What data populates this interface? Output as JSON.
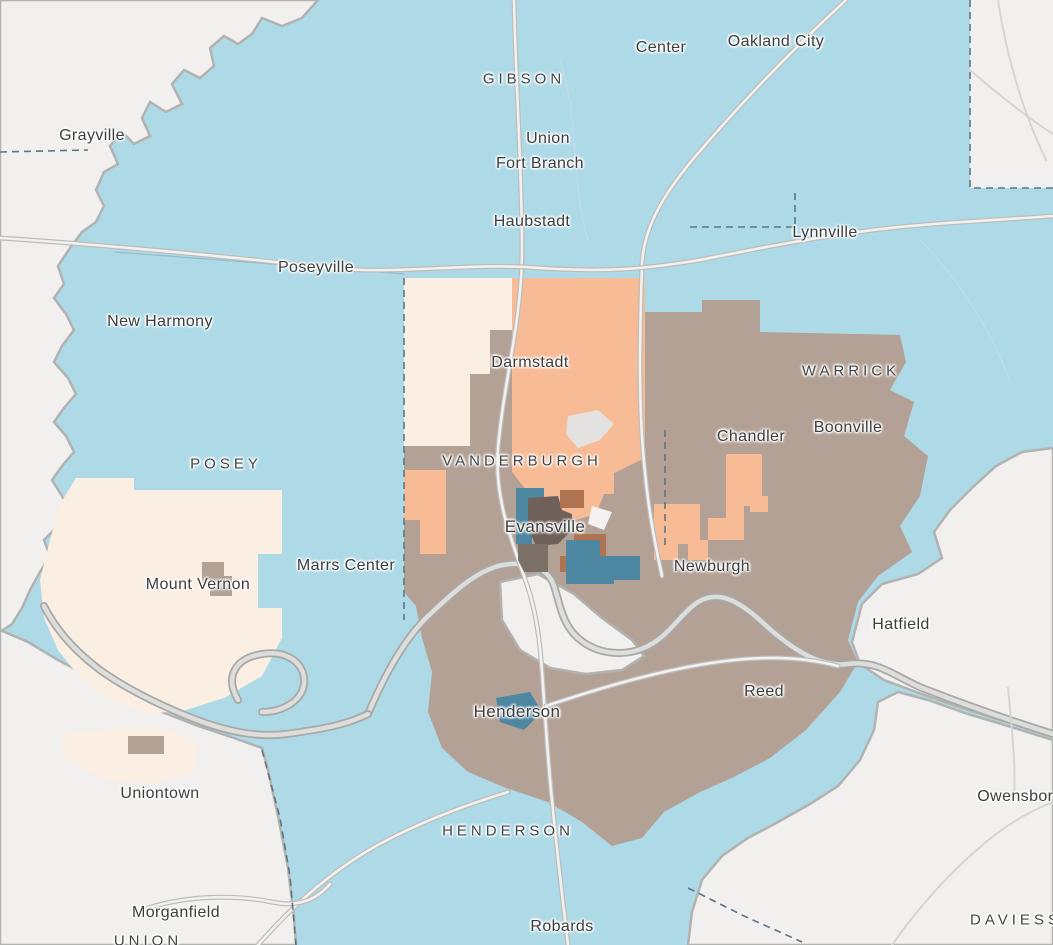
{
  "map": {
    "description": "Choropleth map of the Evansville Indiana-Kentucky tri-state region with census areas shaded by class",
    "palette": {
      "region_blue": "#aedae8",
      "region_tan": "#b3a195",
      "region_orange": "#f7bb96",
      "region_cream": "#fbeee3",
      "tract_teal": "#4e87a2",
      "tract_rust": "#b07352",
      "tract_dark_brown": "#6f6159",
      "tract_gray_brown": "#7d7066",
      "tract_white": "#f4f2f0",
      "airport_gray": "#e4e2e0",
      "out_of_area": "#f1f0ee",
      "river_casing": "#a8a8a6",
      "river_fill": "#dddddc",
      "road_casing": "#bcbcba",
      "road_fill": "#f2f1ef",
      "boundary_dashed": "#5f7682",
      "label_text": "#3e3e3e",
      "label_halo": "#ffffff"
    },
    "labels": [
      {
        "id": "center",
        "text": "Center",
        "kind": "town",
        "x": 661,
        "y": 48
      },
      {
        "id": "oakland-city",
        "text": "Oakland City",
        "kind": "town",
        "x": 776,
        "y": 42
      },
      {
        "id": "gibson",
        "text": "GIBSON",
        "kind": "county",
        "x": 524,
        "y": 79
      },
      {
        "id": "grayville",
        "text": "Grayville",
        "kind": "town",
        "x": 92,
        "y": 136
      },
      {
        "id": "union-gibson",
        "text": "Union",
        "kind": "town",
        "x": 548,
        "y": 139
      },
      {
        "id": "fort-branch",
        "text": "Fort Branch",
        "kind": "town",
        "x": 540,
        "y": 164
      },
      {
        "id": "haubstadt",
        "text": "Haubstadt",
        "kind": "town",
        "x": 532,
        "y": 222
      },
      {
        "id": "lynnville",
        "text": "Lynnville",
        "kind": "town",
        "x": 825,
        "y": 233
      },
      {
        "id": "poseyville",
        "text": "Poseyville",
        "kind": "town",
        "x": 316,
        "y": 268
      },
      {
        "id": "new-harmony",
        "text": "New Harmony",
        "kind": "town",
        "x": 160,
        "y": 322
      },
      {
        "id": "darmstadt",
        "text": "Darmstadt",
        "kind": "town",
        "x": 530,
        "y": 363
      },
      {
        "id": "warrick",
        "text": "WARRICK",
        "kind": "county",
        "x": 851,
        "y": 371
      },
      {
        "id": "boonville",
        "text": "Boonville",
        "kind": "town",
        "x": 848,
        "y": 428
      },
      {
        "id": "chandler",
        "text": "Chandler",
        "kind": "town",
        "x": 751,
        "y": 437
      },
      {
        "id": "posey",
        "text": "POSEY",
        "kind": "county",
        "x": 226,
        "y": 464
      },
      {
        "id": "vanderburgh",
        "text": "VANDERBURGH",
        "kind": "county",
        "x": 522,
        "y": 461
      },
      {
        "id": "evansville",
        "text": "Evansville",
        "kind": "city",
        "x": 545,
        "y": 527
      },
      {
        "id": "marrs-center",
        "text": "Marrs Center",
        "kind": "town",
        "x": 346,
        "y": 566
      },
      {
        "id": "newburgh",
        "text": "Newburgh",
        "kind": "town",
        "x": 712,
        "y": 567
      },
      {
        "id": "mount-vernon",
        "text": "Mount Vernon",
        "kind": "town",
        "x": 198,
        "y": 585
      },
      {
        "id": "hatfield",
        "text": "Hatfield",
        "kind": "town",
        "x": 901,
        "y": 625
      },
      {
        "id": "reed",
        "text": "Reed",
        "kind": "town",
        "x": 764,
        "y": 692
      },
      {
        "id": "henderson-city",
        "text": "Henderson",
        "kind": "city",
        "x": 517,
        "y": 712
      },
      {
        "id": "uniontown",
        "text": "Uniontown",
        "kind": "town",
        "x": 160,
        "y": 794
      },
      {
        "id": "owensboro",
        "text": "Owensboro",
        "kind": "town",
        "x": 1020,
        "y": 797
      },
      {
        "id": "henderson",
        "text": "HENDERSON",
        "kind": "county",
        "x": 508,
        "y": 831
      },
      {
        "id": "morganfield",
        "text": "Morganfield",
        "kind": "town",
        "x": 176,
        "y": 913
      },
      {
        "id": "robards",
        "text": "Robards",
        "kind": "town",
        "x": 562,
        "y": 927
      },
      {
        "id": "daviess",
        "text": "DAVIESS",
        "kind": "county",
        "x": 1016,
        "y": 920
      },
      {
        "id": "union",
        "text": "UNION",
        "kind": "county",
        "x": 148,
        "y": 941
      }
    ]
  }
}
